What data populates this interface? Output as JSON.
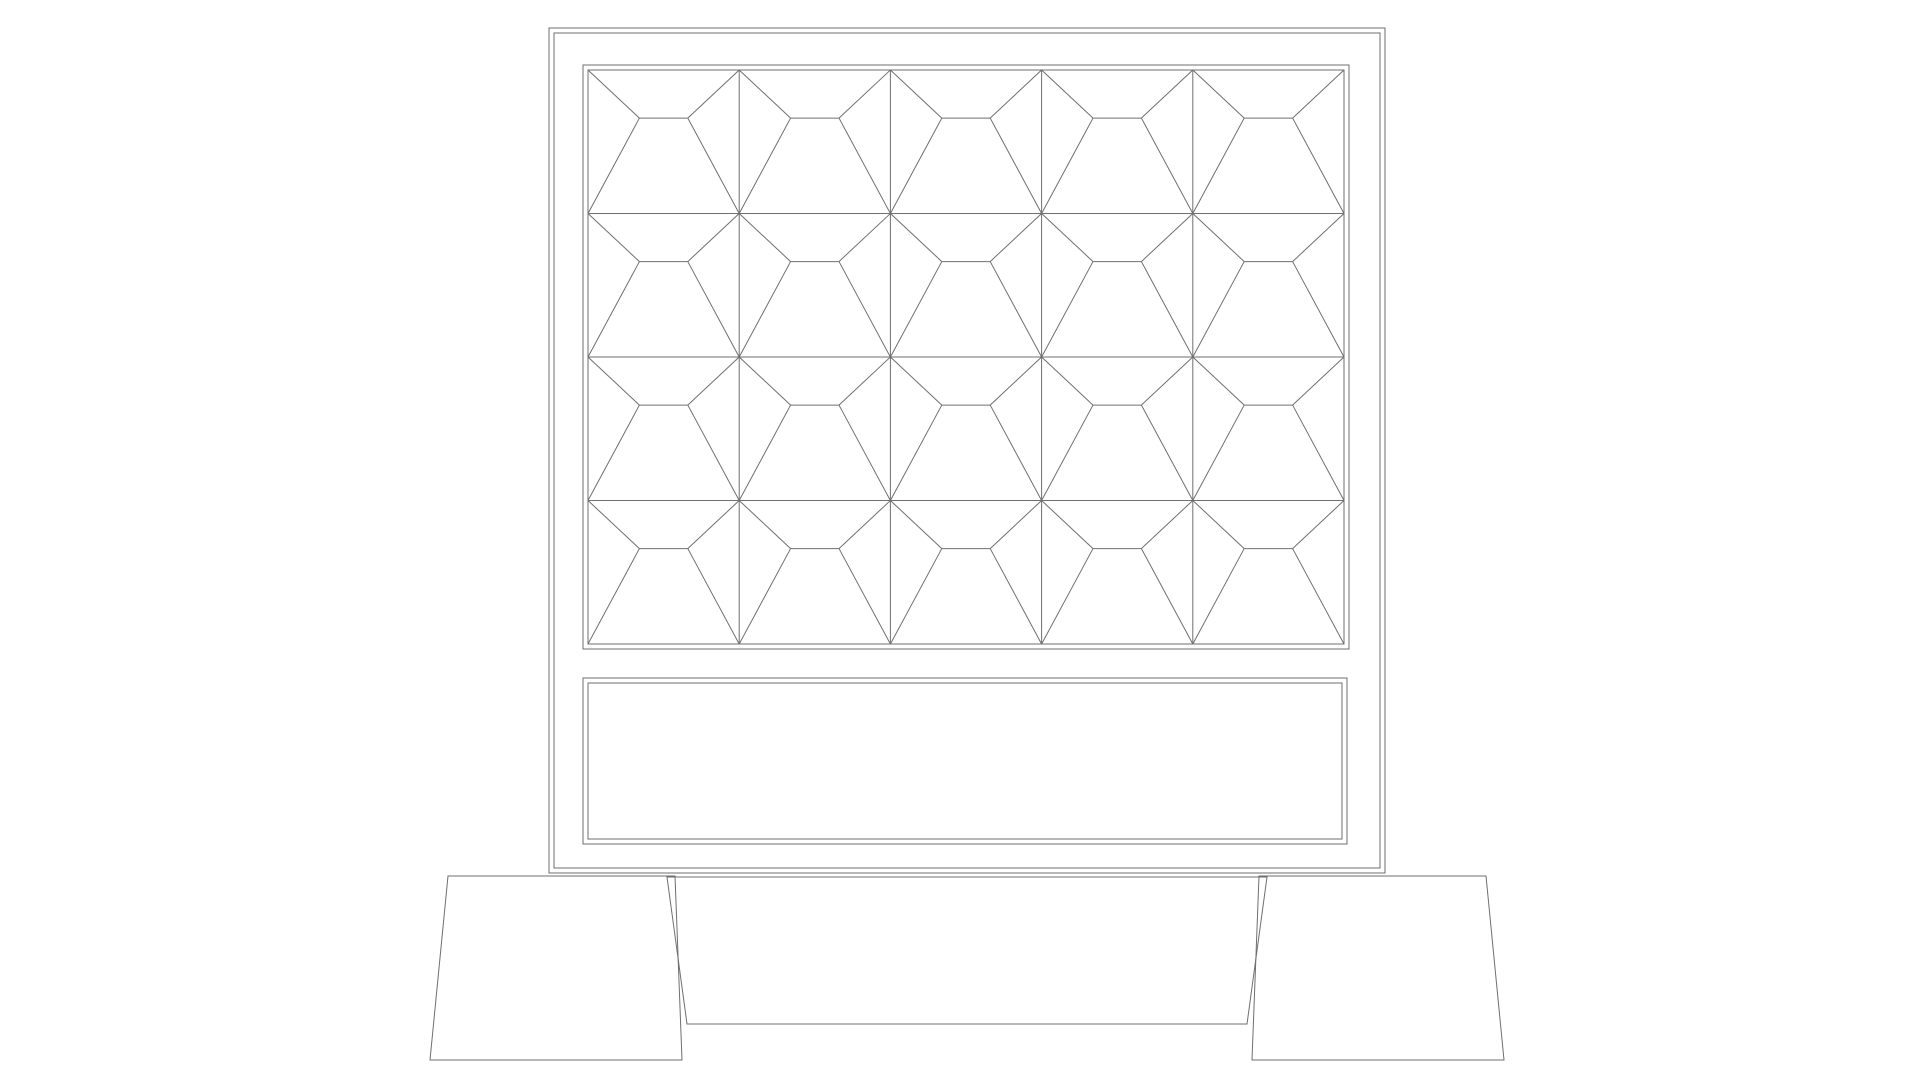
{
  "drawing": {
    "name": "bed-headboard-front-elevation",
    "canvas": {
      "width": 1920,
      "height": 1080,
      "background": "#ffffff"
    },
    "line": {
      "color": "#6f6f6f",
      "width": 1
    },
    "headboard_frame": {
      "outer": {
        "x": 549,
        "y": 28,
        "w": 836,
        "h": 845
      },
      "inner": {
        "x": 554,
        "y": 33,
        "w": 826,
        "h": 835
      }
    },
    "pattern_panel": {
      "outer": {
        "x": 583,
        "y": 65,
        "w": 766,
        "h": 584
      },
      "inner": {
        "x": 588,
        "y": 70,
        "w": 756,
        "h": 574
      },
      "columns": 5,
      "rows": 4,
      "motif": {
        "top_frac": 0.335,
        "left_frac": 0.34,
        "right_frac": 0.66
      }
    },
    "lower_panel": {
      "outer": {
        "x": 583,
        "y": 678,
        "w": 764,
        "h": 166
      },
      "inner": {
        "x": 588,
        "y": 683,
        "w": 754,
        "h": 156
      }
    },
    "bed_base": {
      "points": [
        [
          667,
          877
        ],
        [
          1267,
          877
        ],
        [
          1247,
          1024
        ],
        [
          687,
          1024
        ]
      ]
    },
    "left_leg": {
      "points": [
        [
          448,
          876
        ],
        [
          675,
          876
        ],
        [
          682,
          1060
        ],
        [
          430,
          1060
        ]
      ]
    },
    "right_leg": {
      "points": [
        [
          1259,
          876
        ],
        [
          1486,
          876
        ],
        [
          1504,
          1060
        ],
        [
          1252,
          1060
        ]
      ]
    }
  }
}
